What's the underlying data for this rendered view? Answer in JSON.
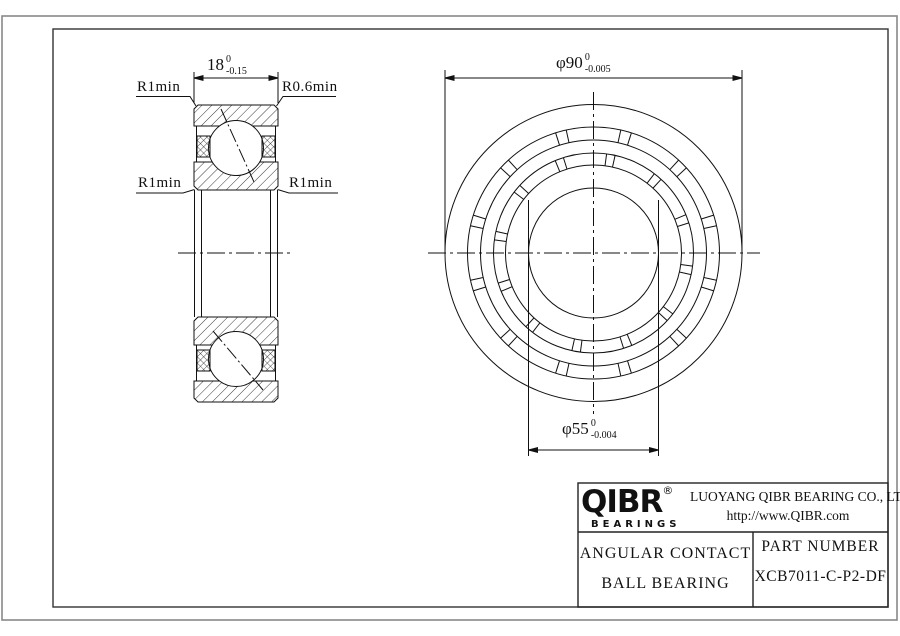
{
  "section_view": {
    "width_dim": {
      "value": "18",
      "tol_top": "0",
      "tol_bottom": "-0.15"
    },
    "labels": {
      "top_left": "R1min",
      "top_right": "R0.6min",
      "mid_left": "R1min",
      "mid_right": "R1min"
    }
  },
  "front_view": {
    "outer_dia_dim": {
      "value": "φ90",
      "tol_top": "0",
      "tol_bottom": "-0.005"
    },
    "bore_dia_dim": {
      "value": "φ55",
      "tol_top": "0",
      "tol_bottom": "-0.004"
    }
  },
  "title_block": {
    "logo": {
      "brand": "QIBR",
      "registered_mark": "®",
      "wordmark_sub": "BEARINGS"
    },
    "company_name": "LUOYANG QIBR BEARING CO., LTD",
    "website": "http://www.QIBR.com",
    "product_type_line1": "ANGULAR CONTACT",
    "product_type_line2": "BALL BEARING",
    "part_number_label": "PART NUMBER",
    "part_number": "XCB7011-C-P2-DF"
  },
  "colors": {
    "line": "#1a1a1a",
    "frame_outer": "#888888",
    "frame_inner": "#333333",
    "background": "#ffffff"
  }
}
